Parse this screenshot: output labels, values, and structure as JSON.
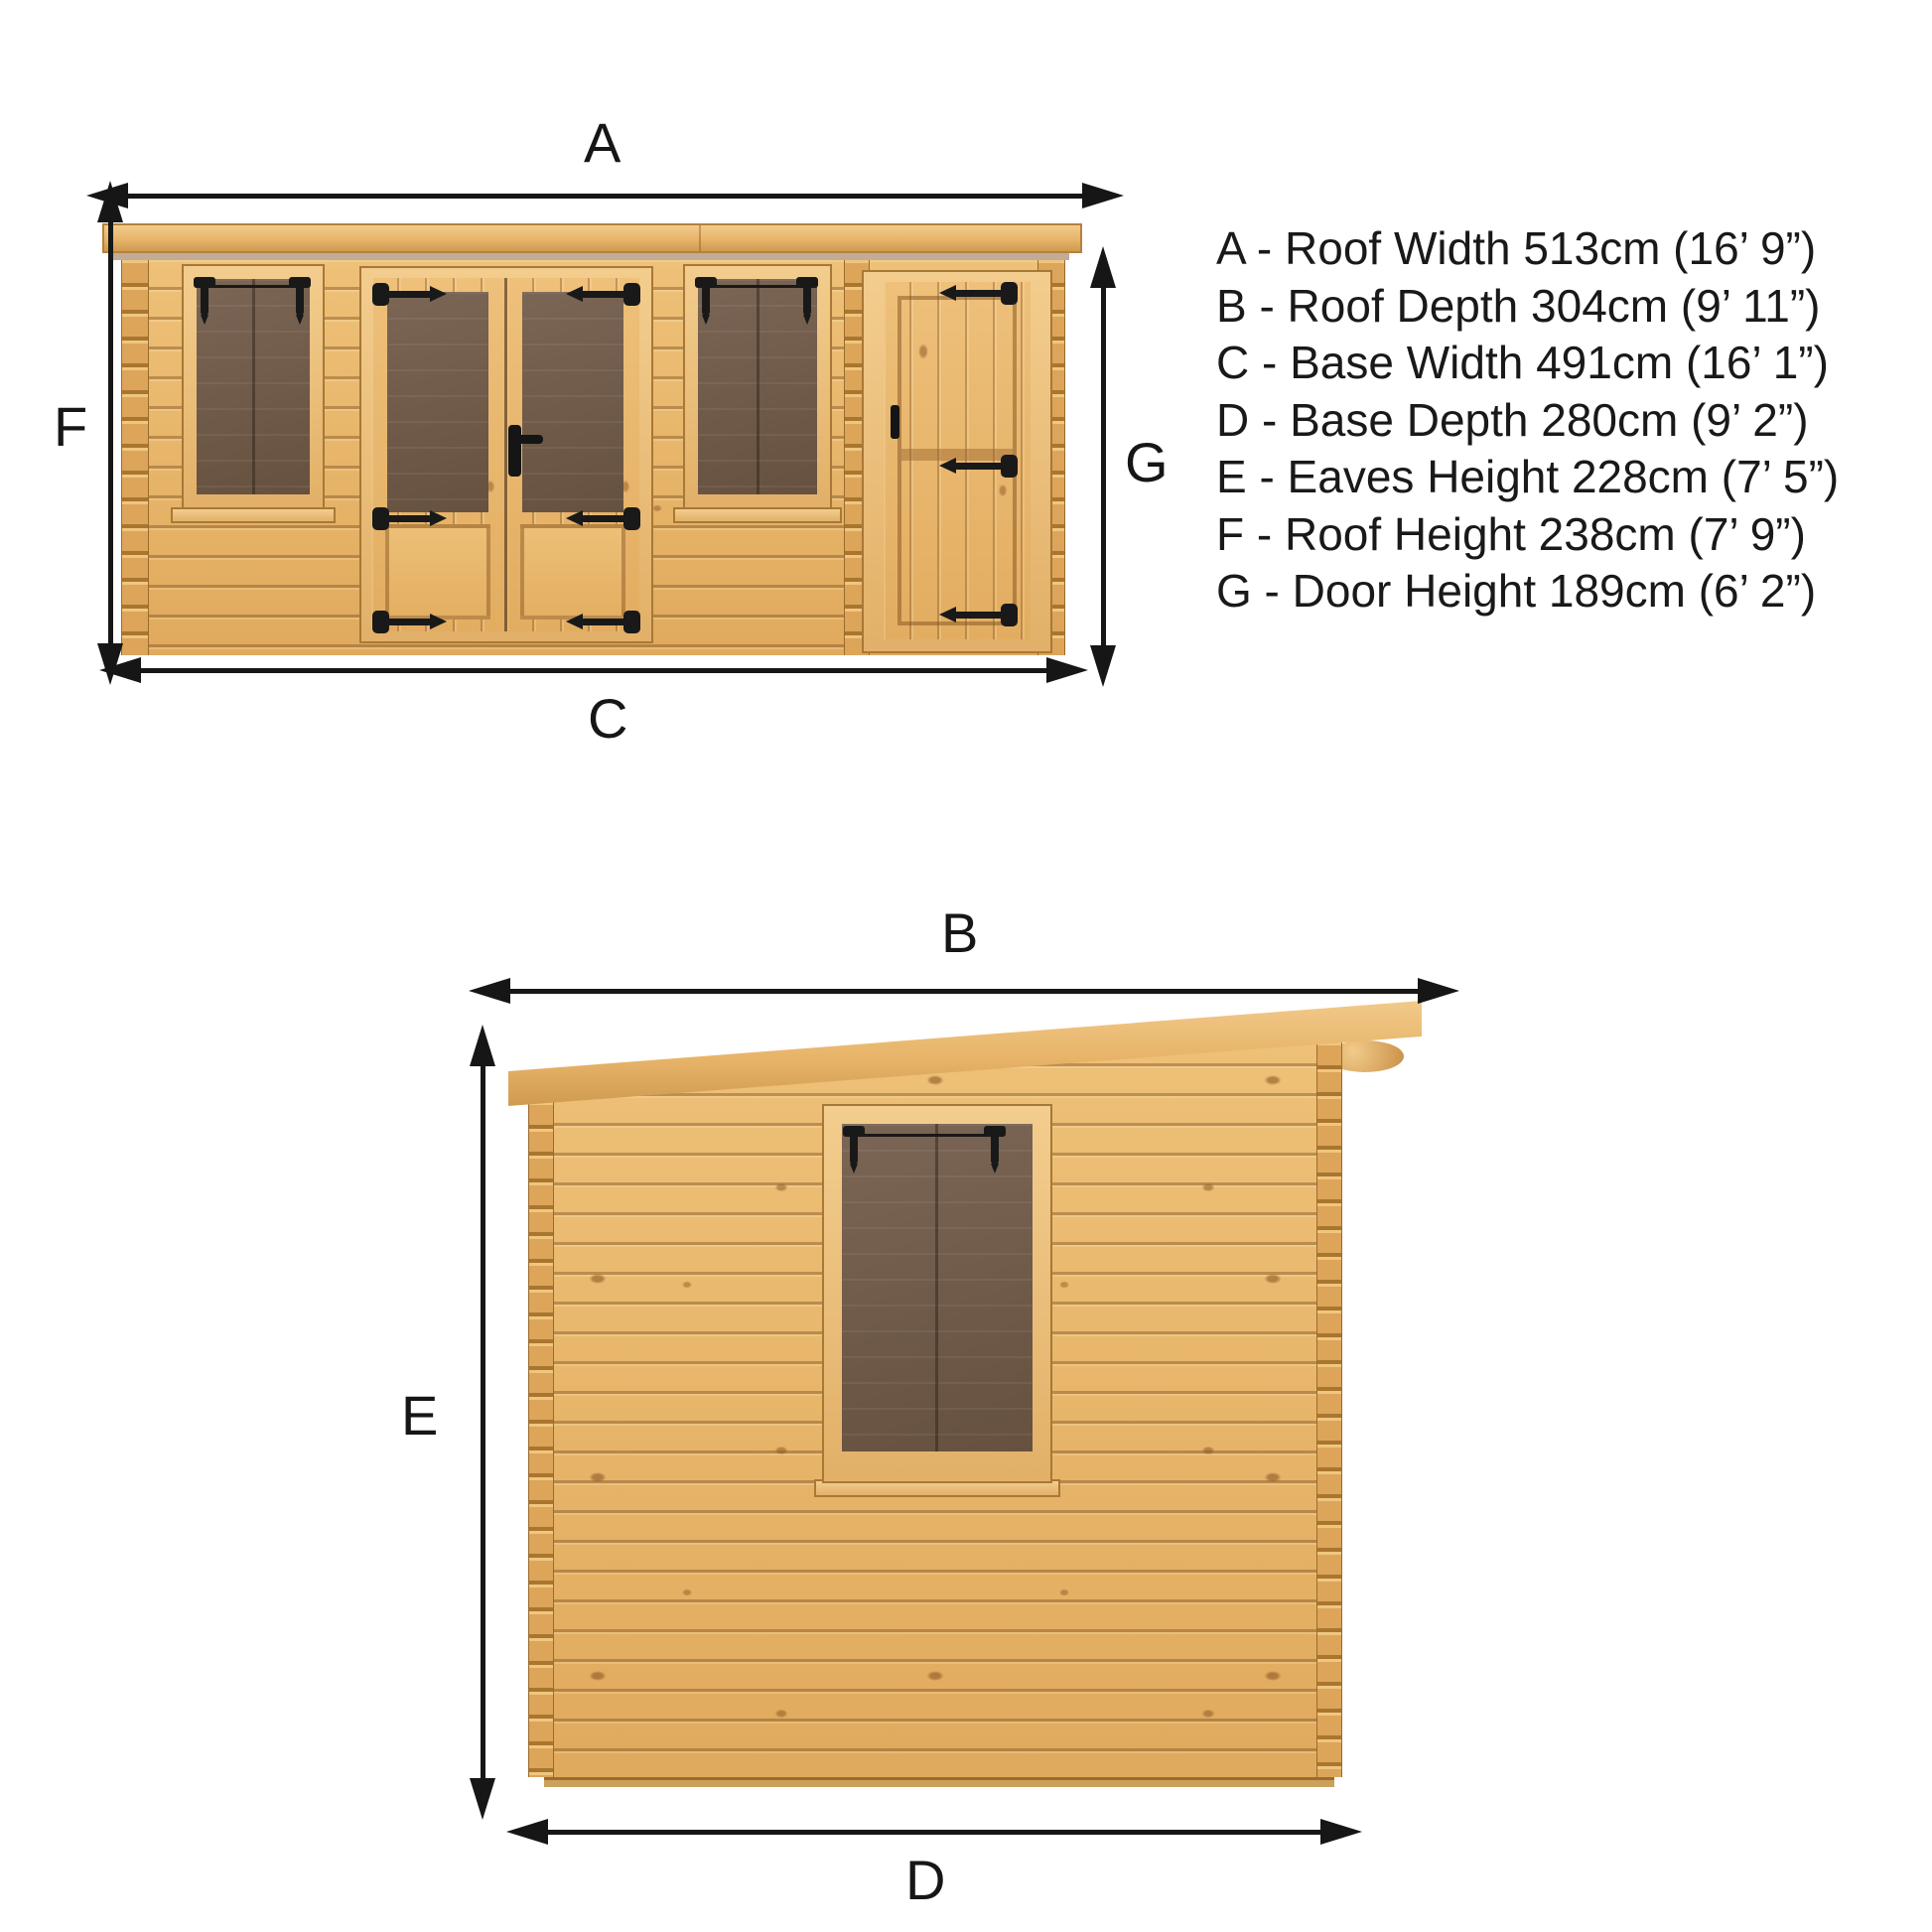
{
  "front_view": {
    "labels": {
      "a": "A",
      "c": "C",
      "f": "F",
      "g": "G"
    }
  },
  "side_view": {
    "labels": {
      "b": "B",
      "d": "D",
      "e": "E"
    }
  },
  "legend": {
    "items": [
      "A - Roof Width 513cm (16’ 9”)",
      "B - Roof Depth 304cm (9’ 11”)",
      "C - Base Width 491cm (16’ 1”)",
      "D - Base Depth 280cm (9’ 2”)",
      "E - Eaves Height 228cm (7’ 5”)",
      "F - Roof Height 238cm (7’ 9”)",
      "G - Door Height 189cm (6’ 2”)"
    ]
  },
  "colors": {
    "background": "#ffffff",
    "wood_light": "#f2cb8c",
    "wood_mid": "#e2ac5e",
    "wood_dark": "#c08445",
    "glazing": "#6e594a",
    "ironmongery": "#191919",
    "dimension_lines": "#161616"
  }
}
